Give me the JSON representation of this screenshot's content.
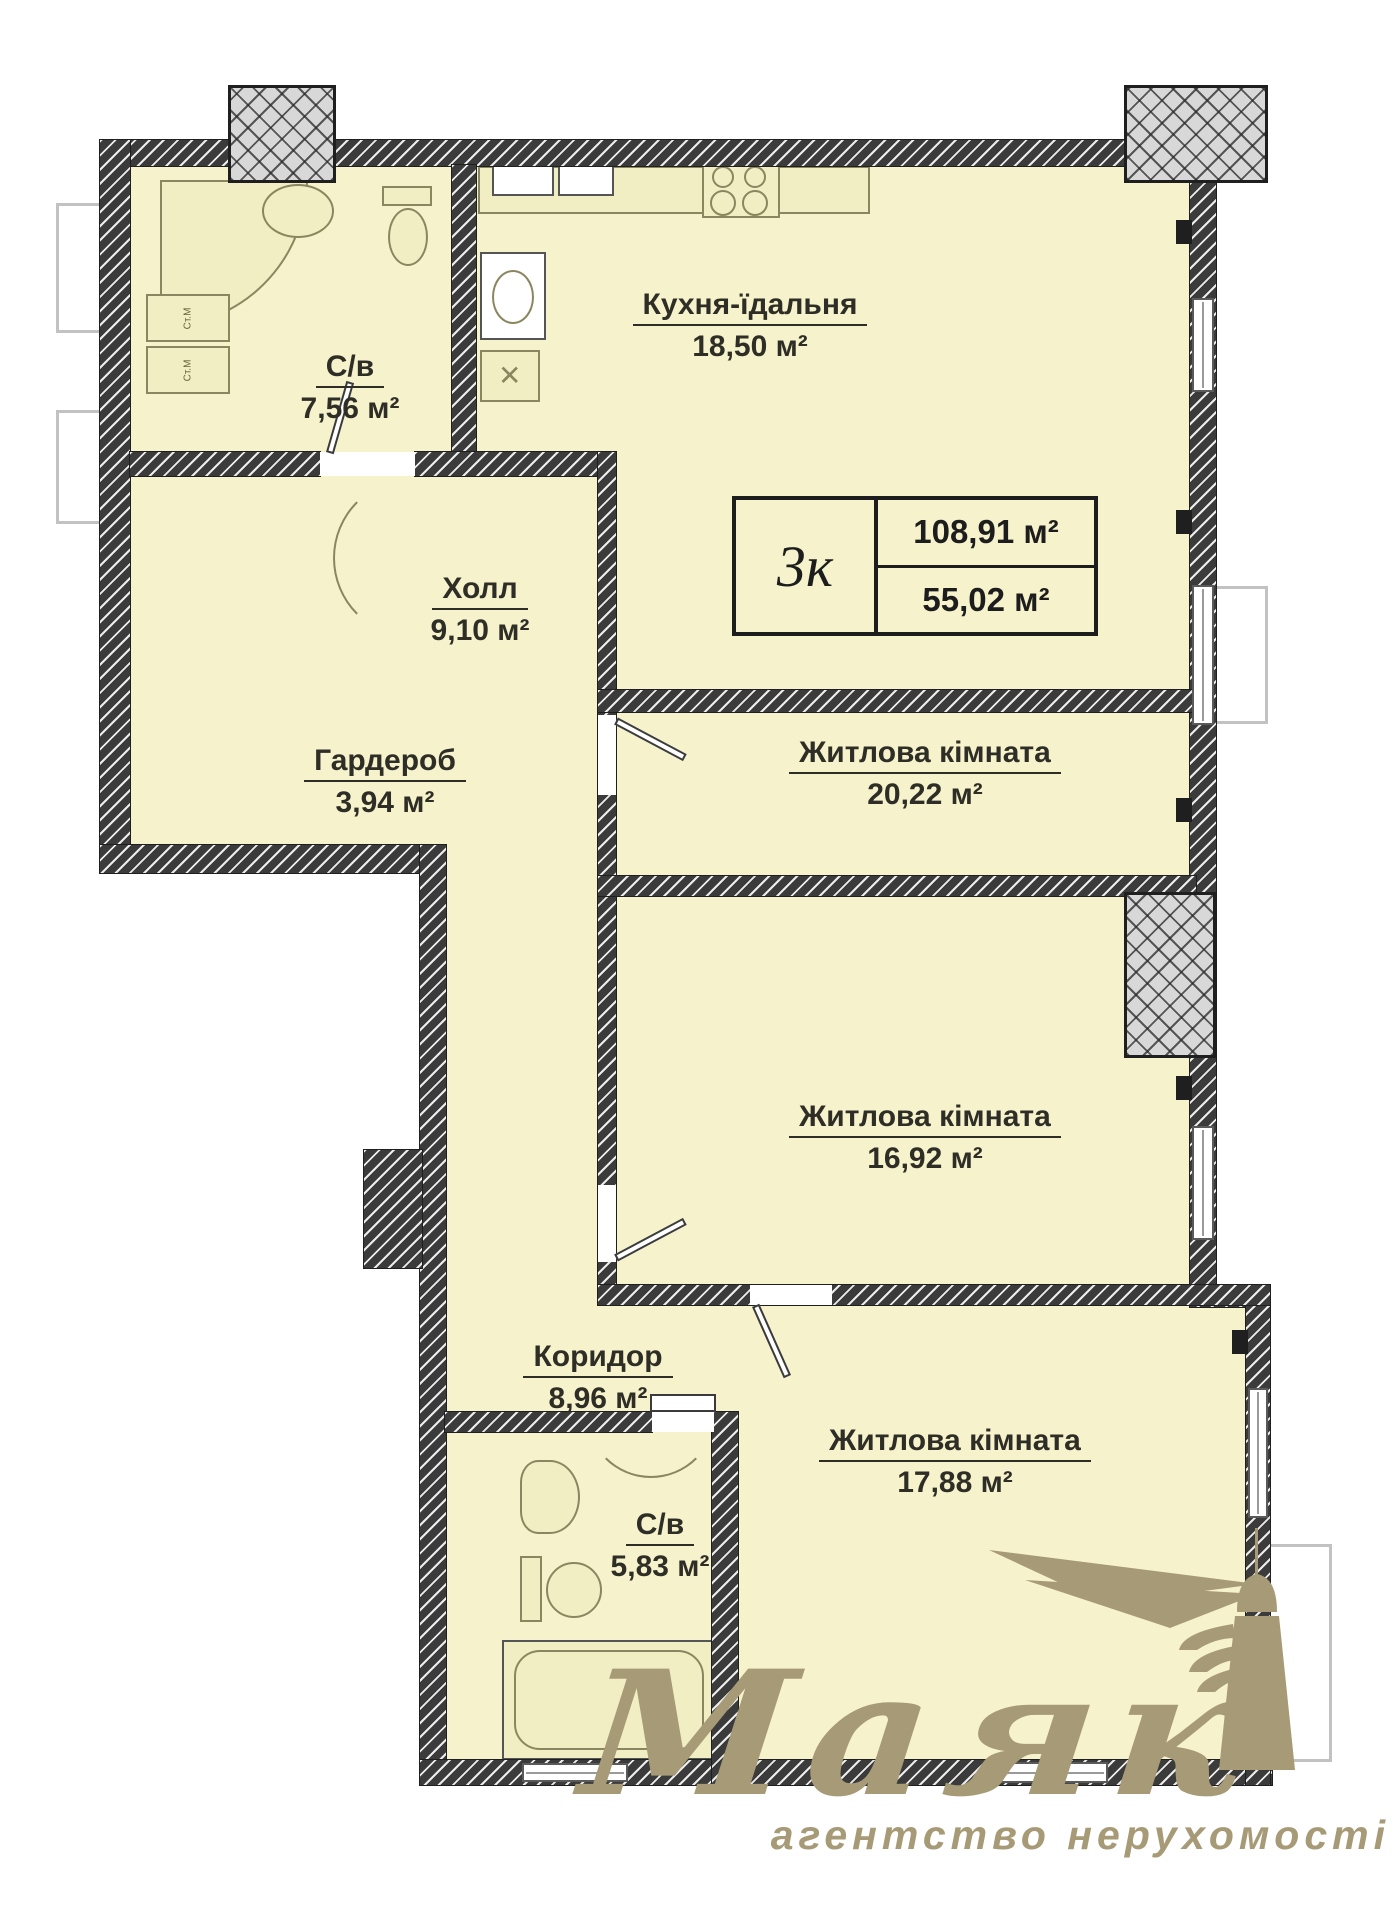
{
  "plan": {
    "legend": {
      "rooms": "3к",
      "total_area": "108,91 м²",
      "living_area": "55,02 м²"
    },
    "rooms": [
      {
        "id": "bathroom-1",
        "name": "С/в",
        "area": "7,56 м²"
      },
      {
        "id": "kitchen",
        "name": "Кухня-їдальня",
        "area": "18,50 м²"
      },
      {
        "id": "hall",
        "name": "Холл",
        "area": "9,10 м²"
      },
      {
        "id": "wardrobe",
        "name": "Гардероб",
        "area": "3,94 м²"
      },
      {
        "id": "living-1",
        "name": "Житлова кімната",
        "area": "20,22 м²"
      },
      {
        "id": "living-2",
        "name": "Житлова кімната",
        "area": "16,92 м²"
      },
      {
        "id": "corridor",
        "name": "Коридор",
        "area": "8,96 м²"
      },
      {
        "id": "bathroom-2",
        "name": "С/в",
        "area": "5,83 м²"
      },
      {
        "id": "living-3",
        "name": "Житлова кімната",
        "area": "17,88 м²"
      }
    ],
    "appliance_labels": {
      "washer": "Ст.М"
    }
  },
  "logo": {
    "name": "Маяк",
    "tagline": "агентство нерухомості"
  },
  "colors": {
    "room_fill": "#f5f2cc",
    "wall": "#3b3b3b",
    "logo_accent": "#a79a76"
  }
}
